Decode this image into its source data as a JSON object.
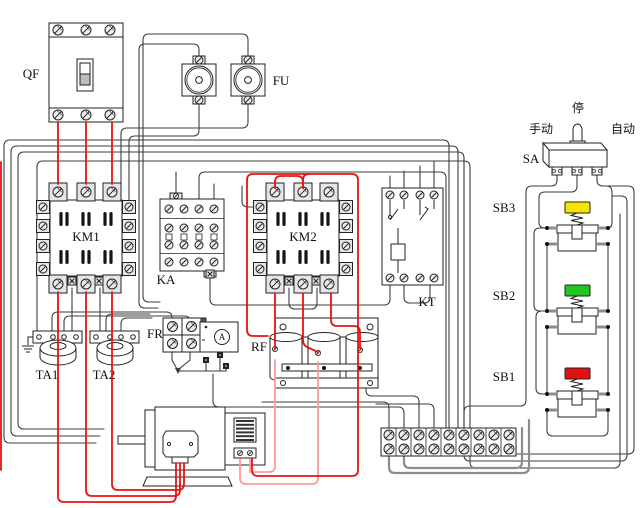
{
  "components": {
    "qf": {
      "label": "QF"
    },
    "fu": {
      "label": "FU"
    },
    "km1": {
      "label": "KM1"
    },
    "ka": {
      "label": "KA"
    },
    "km2": {
      "label": "KM2"
    },
    "kt": {
      "label": "KT"
    },
    "fr": {
      "label": "FR"
    },
    "rf": {
      "label": "RF"
    },
    "ta1": {
      "label": "TA1"
    },
    "ta2": {
      "label": "TA2"
    },
    "ammeter": {
      "label": "A"
    },
    "sa": {
      "label": "SA",
      "position_left": "手动",
      "position_center": "停",
      "position_right": "自动"
    },
    "sb3": {
      "label": "SB3",
      "cap_color": "#f5e400"
    },
    "sb2": {
      "label": "SB2",
      "cap_color": "#1ec81e"
    },
    "sb1": {
      "label": "SB1",
      "cap_color": "#e31212"
    }
  },
  "colors": {
    "power_wire": "#e81313",
    "rotor_wire": "#ff9a9a",
    "control_wire": "#3c3c3c",
    "gray_wire": "#8d8d8d"
  }
}
